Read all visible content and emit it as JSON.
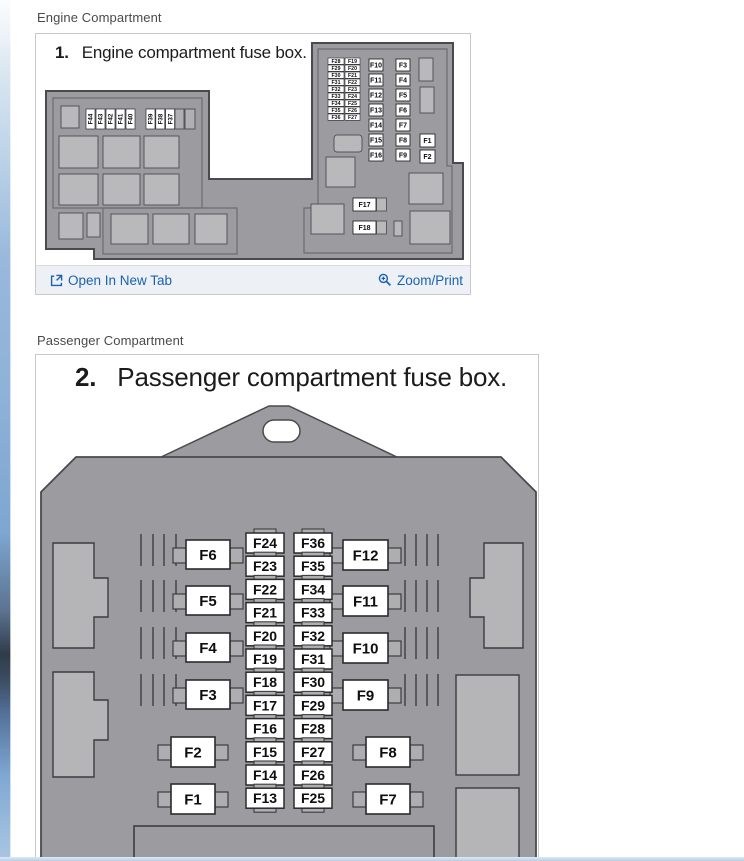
{
  "page": {
    "engine_section_label": "Engine Compartment",
    "passenger_section_label": "Passenger Compartment"
  },
  "engine": {
    "figure_number": "1.",
    "figure_title": "Engine compartment fuse box.",
    "links": {
      "open_in_new_tab": "Open In New Tab",
      "zoom_print": "Zoom/Print"
    },
    "diagram": {
      "vertical_labels_group1": [
        "F44",
        "F43",
        "F42",
        "F41",
        "F40"
      ],
      "vertical_labels_group2": [
        "F39",
        "F38",
        "F37"
      ],
      "pair_rows": [
        [
          "F28",
          "F19"
        ],
        [
          "F29",
          "F20"
        ],
        [
          "F30",
          "F21"
        ],
        [
          "F31",
          "F22"
        ],
        [
          "F32",
          "F23"
        ],
        [
          "F33",
          "F24"
        ],
        [
          "F34",
          "F25"
        ],
        [
          "F35",
          "F26"
        ],
        [
          "F36",
          "F27"
        ]
      ],
      "column_f10_f16": [
        "F10",
        "F11",
        "F12",
        "F13",
        "F14",
        "F15",
        "F16"
      ],
      "column_f3_f9": [
        "F3",
        "F4",
        "F5",
        "F6",
        "F7",
        "F8",
        "F9"
      ],
      "column_f1_f2": [
        "F1",
        "F2"
      ],
      "bottom_fuses": [
        "F17",
        "F18"
      ]
    }
  },
  "passenger": {
    "figure_number": "2.",
    "figure_title": "Passenger compartment fuse box.",
    "diagram": {
      "left_column": [
        "F6",
        "F5",
        "F4",
        "F3"
      ],
      "left_column_lower": [
        "F2",
        "F1"
      ],
      "right_column": [
        "F12",
        "F11",
        "F10",
        "F9"
      ],
      "right_column_lower": [
        "F8",
        "F7"
      ],
      "mid_left_column": [
        "F24",
        "F23",
        "F22",
        "F21",
        "F20",
        "F19",
        "F18",
        "F17",
        "F16",
        "F15",
        "F14",
        "F13"
      ],
      "mid_right_column": [
        "F36",
        "F35",
        "F34",
        "F33",
        "F32",
        "F31",
        "F30",
        "F29",
        "F28",
        "F27",
        "F26",
        "F25"
      ]
    }
  },
  "colors": {
    "link_blue": "#1a61b0",
    "footer_bg": "#edf1f6",
    "diagram_body_gray": "#9c9ca0",
    "diagram_light_gray": "#b9b9bc",
    "diagram_outline": "#4a4a4e",
    "fuse_white": "#ffffff"
  }
}
